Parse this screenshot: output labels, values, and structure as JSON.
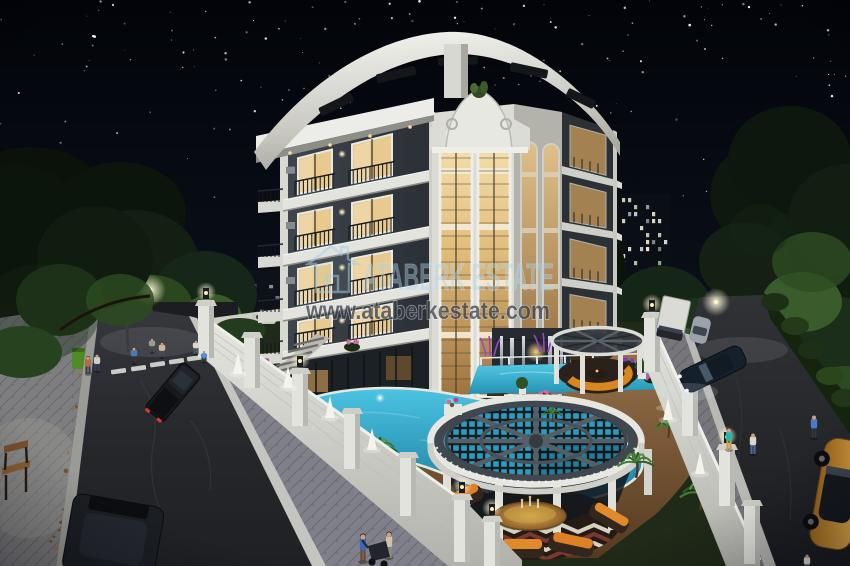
{
  "meta": {
    "title": "Night architectural render",
    "canvas_width": 850,
    "canvas_height": 566
  },
  "watermark": {
    "brand": "ATABERK ESTATE",
    "url": "www.ataberkestate.com",
    "logo_icon": "house-outline-icon",
    "brand_color": "#a9cde5",
    "url_color": "#343a42"
  },
  "scene": {
    "alt": "Night-time 3D architectural rendering of a five-storey luxury apartment building with warmly lit windows, a curved white roof crown, landscaped garden with turquoise swimming pools, a large circular latticed pergola over the pool, white perimeter walls, and two streets with cars and pedestrians under a starry sky",
    "palette": {
      "sky_top": "#020409",
      "sky_bottom": "#101826",
      "building_wall_dark": "#33383e",
      "building_trim_white": "#e9e9e4",
      "window_glow_warm": "#f2dfae",
      "pool_turquoise": "#2fa8cc",
      "deck_wood": "#84603e",
      "foliage_dark": "#16241a",
      "foliage_lit": "#4c7038",
      "road_asphalt": "#26282c",
      "sidewalk_paver": "#85858a",
      "perimeter_wall_white": "#d7d7d2",
      "cushion_orange": "#d8821f",
      "gold_car": "#c9842c"
    }
  }
}
